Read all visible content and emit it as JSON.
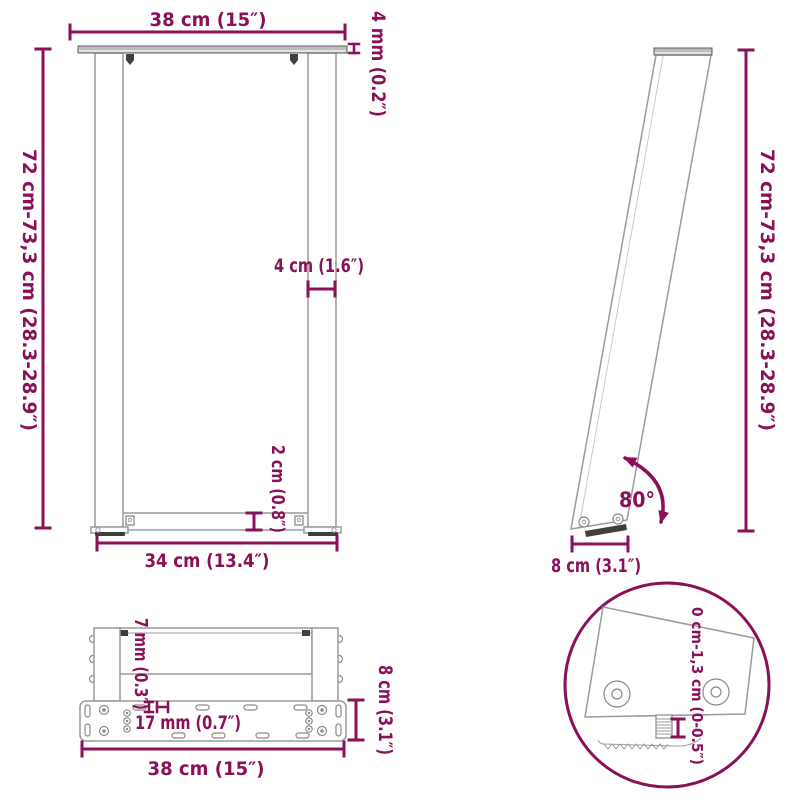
{
  "diagram_title": "table-leg-dimension-diagram",
  "colors": {
    "dimension": "#8a1057",
    "outline": "#9a9a9a",
    "metal_fill": "#bdbdbd",
    "dark_pad": "#3f3f3f"
  },
  "front_view": {
    "width_top": "38 cm (15″)",
    "top_plate_thickness": "4 mm (0.2″)",
    "height_range": "72 cm-73,3 cm (28.3-28.9″)",
    "leg_width": "4 cm (1.6″)",
    "crossbar_thickness": "2 cm (0.8″)",
    "width_bottom": "34 cm (13.4″)"
  },
  "side_view": {
    "height_range": "72 cm-73,3 cm (28.3-28.9″)",
    "angle": "80°",
    "foot_depth": "8 cm (3.1″)"
  },
  "bottom_view": {
    "bar_thickness": "7 mm (0.3″)",
    "hole_pitch": "17 mm (0.7″)",
    "plate_width": "38 cm (15″)",
    "plate_depth": "8 cm (3.1″)"
  },
  "detail_view": {
    "adjustable_range": "0 cm-1,3 cm (0-0.5″)"
  }
}
